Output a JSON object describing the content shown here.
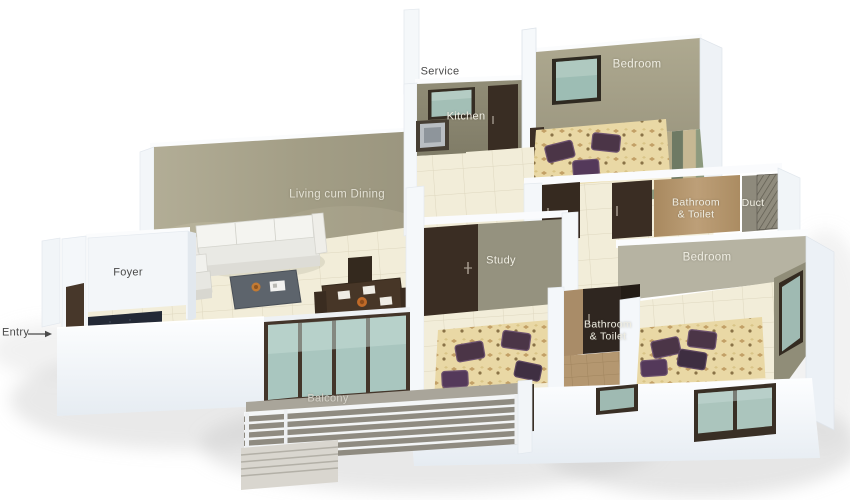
{
  "scene": {
    "description": "3D isometric floor plan of an apartment viewed from above",
    "background": "#ffffff"
  },
  "labels": {
    "service": "Service",
    "kitchen": "Kitchen",
    "bedroom_top": "Bedroom",
    "living_dining": "Living cum Dining",
    "foyer": "Foyer",
    "entry": "Entry",
    "study": "Study",
    "duct": "Duct",
    "bedroom_right": "Bedroom",
    "balcony": "Balcony",
    "bathroom_toilet_top": {
      "line1": "Bathroom",
      "line2": "& Toilet"
    },
    "bathroom_toilet_mid": {
      "line1": "Bathroom",
      "line2": "& Toilet"
    }
  },
  "palette": {
    "wall_olive_kitchen": "#8c8873",
    "wall_beige_bedroom": "#a6a28b",
    "wall_living": "#a39e86",
    "wall_tan_bathroom": "#b3946e",
    "wall_gray_study": "#95927f",
    "wall_exterior_white": "#f4f7fa",
    "floor_tile_cream": "#f2edd9",
    "floor_plank_green": "#6e7a64",
    "floor_plank_tan": "#c6b893",
    "floor_bathroom_tan": "#b49770",
    "door_dark_brown": "#3a2d23",
    "glass_teal": "#a9c6bf",
    "bed_gold": "#e9d8a5",
    "pillow_purple": "#4a3448",
    "balcony_floor_gray": "#a9a59a",
    "label_dark": "#4a4a4a",
    "label_light": "#f0eee3"
  }
}
